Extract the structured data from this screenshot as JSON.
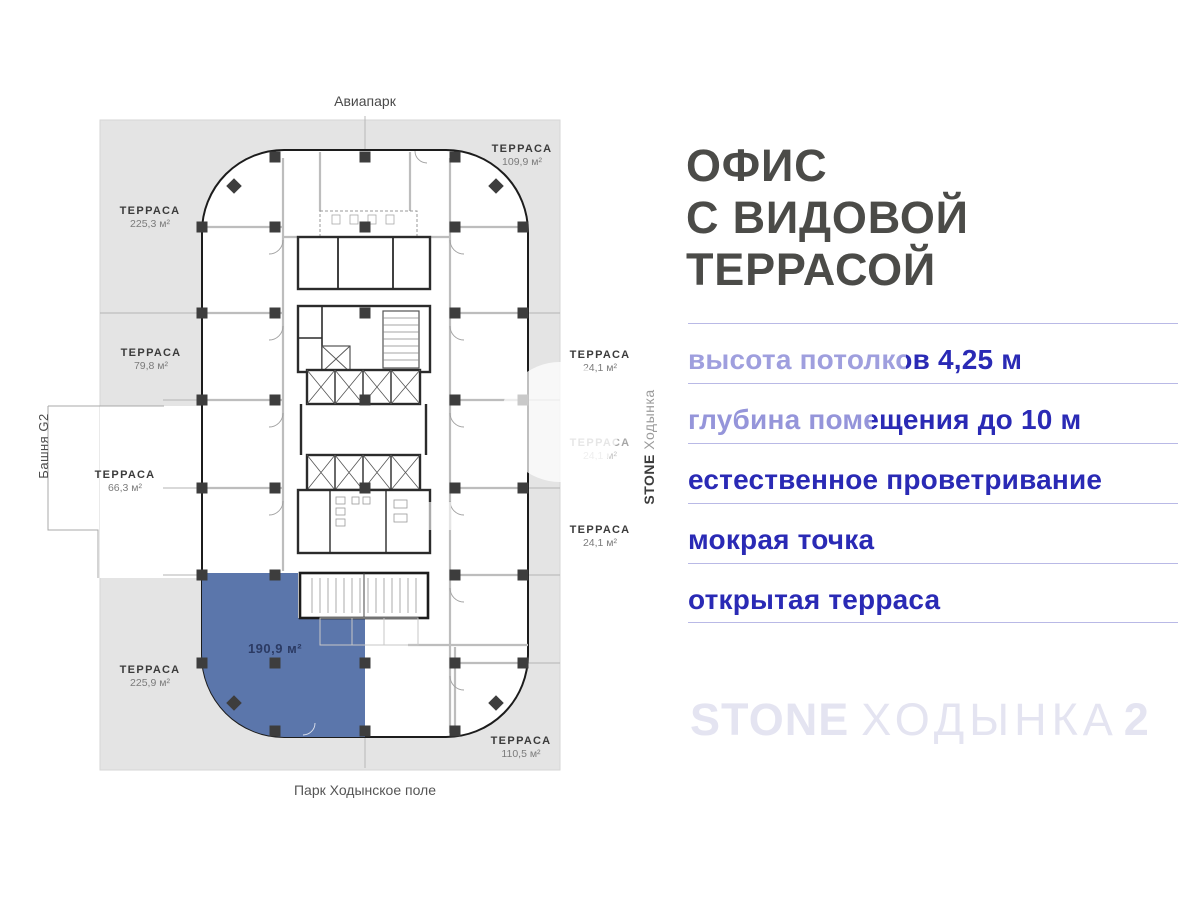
{
  "plan": {
    "north_label": "Авиапарк",
    "south_label": "Парк Ходынское поле",
    "west_label": "Башня G2",
    "east_label": {
      "brand": "STONE",
      "project": "Ходынка"
    },
    "highlighted_unit_area": "190,9 м²",
    "terraces": [
      {
        "label": "ТЕРРАСА",
        "area": "225,3 м²"
      },
      {
        "label": "ТЕРРАСА",
        "area": "109,9 м²"
      },
      {
        "label": "ТЕРРАСА",
        "area": "79,8 м²"
      },
      {
        "label": "ТЕРРАСА",
        "area": "66,3 м²"
      },
      {
        "label": "ТЕРРАСА",
        "area": "24,1 м²"
      },
      {
        "label": "ТЕРРАСА",
        "area": "24,1 м²"
      },
      {
        "label": "ТЕРРАСА",
        "area": "24,1 м²"
      },
      {
        "label": "ТЕРРАСА",
        "area": "225,9 м²"
      },
      {
        "label": "ТЕРРАСА",
        "area": "110,5 м²"
      }
    ]
  },
  "sidebar": {
    "heading_lines": [
      "ОФИС",
      "С ВИДОВОЙ",
      "ТЕРРАСОЙ"
    ],
    "features": [
      "высота потолков 4,25 м",
      "глубина помещения до 10 м",
      "естественное проветривание",
      "мокрая точка",
      "открытая терраса"
    ],
    "logo": {
      "brand": "STONE",
      "project": "ХОДЫНКА",
      "number": "2"
    }
  },
  "colors": {
    "terrace_gray": "#e4e4e4",
    "highlight_blue": "#5b76ab",
    "feature_blue": "#2a2ab5",
    "divider": "#b9b9e6",
    "heading_gray": "#4b4b48",
    "logo_lavender": "#e4e4f1"
  }
}
